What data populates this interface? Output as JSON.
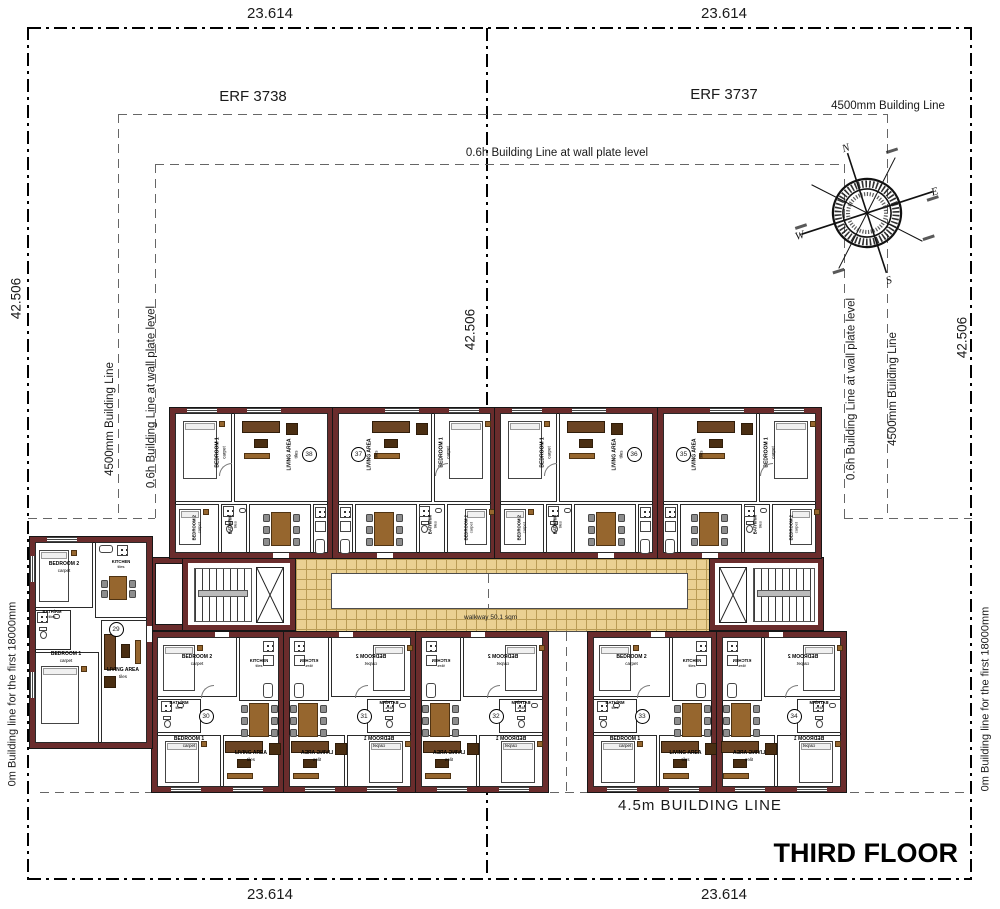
{
  "drawing": {
    "title": "THIRD FLOOR",
    "erf_left": "ERF 3738",
    "erf_right": "ERF 3737",
    "walkway_label": "walkway 50.1 sqm",
    "bottom_building_line_label": "4.5m BUILDING LINE"
  },
  "dimensions": {
    "top_left": "23.614",
    "top_right": "23.614",
    "bottom_left": "23.614",
    "bottom_right": "23.614",
    "left_vertical": "42.506",
    "center_vertical": "42.506",
    "right_vertical": "42.506"
  },
  "building_lines": {
    "line_4500_label": "4500mm Building Line",
    "line_06h_label": "0.6h Building Line at wall plate level",
    "line_0m_label": "0m Building line for the first 18000mm"
  },
  "compass": {
    "north": "N",
    "east": "E",
    "south": "S",
    "west": "W"
  },
  "room_types": {
    "bedroom1": {
      "name": "BEDROOM 1",
      "finish": "carpet"
    },
    "bedroom2": {
      "name": "BEDROOM 2",
      "finish": "carpet"
    },
    "living": {
      "name": "LIVING AREA",
      "finish": "tiles"
    },
    "kitchen": {
      "name": "KITCHEN",
      "finish": "tiles"
    },
    "bath": {
      "name": "BATH/RM",
      "finish": "tiles"
    },
    "dining": {
      "name": "DINING",
      "finish": "tiles"
    }
  },
  "units": {
    "side": {
      "number": "29",
      "flipped": false,
      "mirrored_text": false
    },
    "top_row": [
      {
        "number": "38",
        "flipped": false,
        "mirrored_text": false
      },
      {
        "number": "37",
        "flipped": true,
        "mirrored_text": false
      },
      {
        "number": "36",
        "flipped": false,
        "mirrored_text": false
      },
      {
        "number": "35",
        "flipped": true,
        "mirrored_text": false
      }
    ],
    "bottom_left_block": [
      {
        "number": "30",
        "flipped": false,
        "mirrored_text": false
      },
      {
        "number": "31",
        "flipped": true,
        "mirrored_text": true
      },
      {
        "number": "32",
        "flipped": true,
        "mirrored_text": true
      }
    ],
    "bottom_right_block": [
      {
        "number": "33",
        "flipped": false,
        "mirrored_text": false
      },
      {
        "number": "34",
        "flipped": true,
        "mirrored_text": true
      }
    ]
  },
  "colors": {
    "wall": "#6a2c2c",
    "walkway_tile": "#ead092",
    "furniture_wood": "#96662e",
    "sofa": "#6b4423",
    "chair": "#8d8d8d"
  }
}
